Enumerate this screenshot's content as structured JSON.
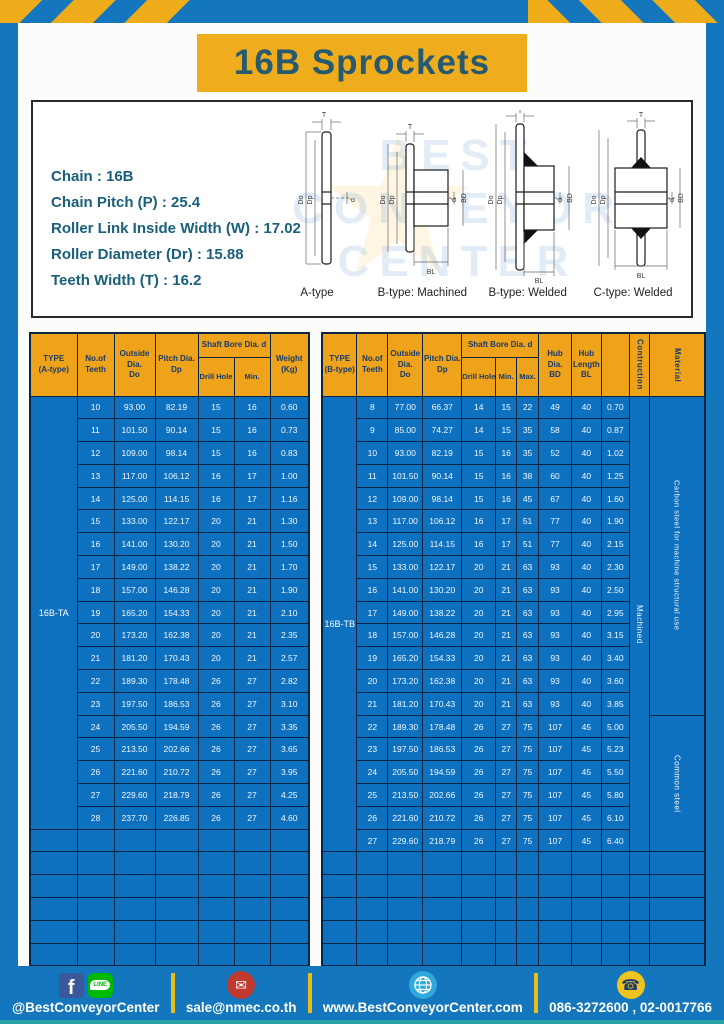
{
  "page": {
    "title": "16B Sprockets"
  },
  "colors": {
    "frame_blue": "#1477bd",
    "table_blue": "#0e71c0",
    "header_orange": "#efa31b",
    "banner_yellow": "#efad1d",
    "title_teal": "#27596f",
    "border_navy": "#0a2443",
    "footer_separator_yellow": "#e9bd18",
    "bottom_strip_teal": "#2aa3a8"
  },
  "specs": {
    "lines": [
      "Chain  :  16B",
      "Chain Pitch (P)  :  25.4",
      "Roller Link Inside Width (W)  :  17.02",
      "Roller Diameter (Dr)  : 15.88",
      "Teeth Width (T)  :  16.2"
    ]
  },
  "watermark": {
    "line1": "BEST",
    "line2": "CONVEYOR",
    "line3": "CENTER"
  },
  "diagrams": {
    "captions": [
      "A-type",
      "B-type: Machined",
      "B-type: Welded",
      "C-type: Welded"
    ],
    "dims": {
      "t": "T",
      "do": "Do",
      "dp": "Dp",
      "d": "d",
      "bd": "BD",
      "bl": "BL"
    }
  },
  "table_a": {
    "header": {
      "type": "TYPE\n(A-type)",
      "teeth": "No.of\nTeeth",
      "outside": "Outside\nDia.\nDo",
      "pitch": "Pitch Dia.\nDp",
      "shaft_bore": "Shaft Bore Dia. d",
      "drill": "Drill Hole",
      "min": "Min.",
      "weight": "Weight\n(Kg)"
    },
    "type_label": "16B-TA",
    "rows": [
      [
        "10",
        "93.00",
        "82.19",
        "15",
        "16",
        "0.60"
      ],
      [
        "11",
        "101.50",
        "90.14",
        "15",
        "16",
        "0.73"
      ],
      [
        "12",
        "109.00",
        "98.14",
        "15",
        "16",
        "0.83"
      ],
      [
        "13",
        "117.00",
        "106.12",
        "16",
        "17",
        "1.00"
      ],
      [
        "14",
        "125.00",
        "114.15",
        "16",
        "17",
        "1.16"
      ],
      [
        "15",
        "133.00",
        "122.17",
        "20",
        "21",
        "1.30"
      ],
      [
        "16",
        "141.00",
        "130.20",
        "20",
        "21",
        "1.50"
      ],
      [
        "17",
        "149.00",
        "138.22",
        "20",
        "21",
        "1.70"
      ],
      [
        "18",
        "157.00",
        "146.28",
        "20",
        "21",
        "1.90"
      ],
      [
        "19",
        "165.20",
        "154.33",
        "20",
        "21",
        "2.10"
      ],
      [
        "20",
        "173.20",
        "162.38",
        "20",
        "21",
        "2.35"
      ],
      [
        "21",
        "181.20",
        "170.43",
        "20",
        "21",
        "2.57"
      ],
      [
        "22",
        "189.30",
        "178.48",
        "26",
        "27",
        "2.82"
      ],
      [
        "23",
        "197.50",
        "186.53",
        "26",
        "27",
        "3.10"
      ],
      [
        "24",
        "205.50",
        "194.59",
        "26",
        "27",
        "3.35"
      ],
      [
        "25",
        "213.50",
        "202.66",
        "26",
        "27",
        "3.65"
      ],
      [
        "26",
        "221.60",
        "210.72",
        "26",
        "27",
        "3.95"
      ],
      [
        "27",
        "229.60",
        "218.79",
        "26",
        "27",
        "4.25"
      ],
      [
        "28",
        "237.70",
        "226.85",
        "26",
        "27",
        "4.60"
      ]
    ],
    "empty_rows": 6
  },
  "table_b": {
    "header": {
      "type": "TYPE\n(B-type)",
      "teeth": "No.of\nTeeth",
      "outside": "Outside\nDia.\nDo",
      "pitch": "Pitch Dia.\nDp",
      "shaft_bore": "Shaft Bore Dia. d",
      "drill": "Drill Hole",
      "min": "Min.",
      "max": "Max.",
      "hub_dia": "Hub Dia.\nBD",
      "hub_len": "Hub\nLength\nBL",
      "construction": "Contruction",
      "material": "Material"
    },
    "type_label": "16B-TB",
    "rows": [
      [
        "8",
        "77.00",
        "66.37",
        "14",
        "15",
        "22",
        "49",
        "40",
        "0.70"
      ],
      [
        "9",
        "85.00",
        "74.27",
        "14",
        "15",
        "35",
        "58",
        "40",
        "0.87"
      ],
      [
        "10",
        "93.00",
        "82.19",
        "15",
        "16",
        "35",
        "52",
        "40",
        "1.02"
      ],
      [
        "11",
        "101.50",
        "90.14",
        "15",
        "16",
        "38",
        "60",
        "40",
        "1.25"
      ],
      [
        "12",
        "109.00",
        "98.14",
        "15",
        "16",
        "45",
        "67",
        "40",
        "1.60"
      ],
      [
        "13",
        "117.00",
        "106.12",
        "16",
        "17",
        "51",
        "77",
        "40",
        "1.90"
      ],
      [
        "14",
        "125.00",
        "114.15",
        "16",
        "17",
        "51",
        "77",
        "40",
        "2.15"
      ],
      [
        "15",
        "133.00",
        "122.17",
        "20",
        "21",
        "63",
        "93",
        "40",
        "2.30"
      ],
      [
        "16",
        "141.00",
        "130.20",
        "20",
        "21",
        "63",
        "93",
        "40",
        "2.50"
      ],
      [
        "17",
        "149.00",
        "138.22",
        "20",
        "21",
        "63",
        "93",
        "40",
        "2.95"
      ],
      [
        "18",
        "157.00",
        "146.28",
        "20",
        "21",
        "63",
        "93",
        "40",
        "3.15"
      ],
      [
        "19",
        "165.20",
        "154.33",
        "20",
        "21",
        "63",
        "93",
        "40",
        "3.40"
      ],
      [
        "20",
        "173.20",
        "162.38",
        "20",
        "21",
        "63",
        "93",
        "40",
        "3.60"
      ],
      [
        "21",
        "181.20",
        "170.43",
        "20",
        "21",
        "63",
        "93",
        "40",
        "3.85"
      ],
      [
        "22",
        "189.30",
        "178.48",
        "26",
        "27",
        "75",
        "107",
        "45",
        "5.00"
      ],
      [
        "23",
        "197.50",
        "186.53",
        "26",
        "27",
        "75",
        "107",
        "45",
        "5.23"
      ],
      [
        "24",
        "205.50",
        "194.59",
        "26",
        "27",
        "75",
        "107",
        "45",
        "5.50"
      ],
      [
        "25",
        "213.50",
        "202.66",
        "26",
        "27",
        "75",
        "107",
        "45",
        "5.80"
      ],
      [
        "26",
        "221.60",
        "210.72",
        "26",
        "27",
        "75",
        "107",
        "45",
        "6.10"
      ],
      [
        "27",
        "229.60",
        "218.79",
        "26",
        "27",
        "75",
        "107",
        "45",
        "6.40"
      ]
    ],
    "construction_value": "Machined",
    "material": {
      "top": "Carbon steel for machine structural use",
      "top_span": 14,
      "bottom": "Common steel",
      "bottom_span": 6
    },
    "empty_rows": 5
  },
  "footer": {
    "social": "@BestConveyorCenter",
    "line_label": "LINE",
    "fb_letter": "f",
    "email": "sale@nmec.co.th",
    "website": "www.BestConveyorCenter.com",
    "phone": "086-3272600 , 02-0017766"
  }
}
